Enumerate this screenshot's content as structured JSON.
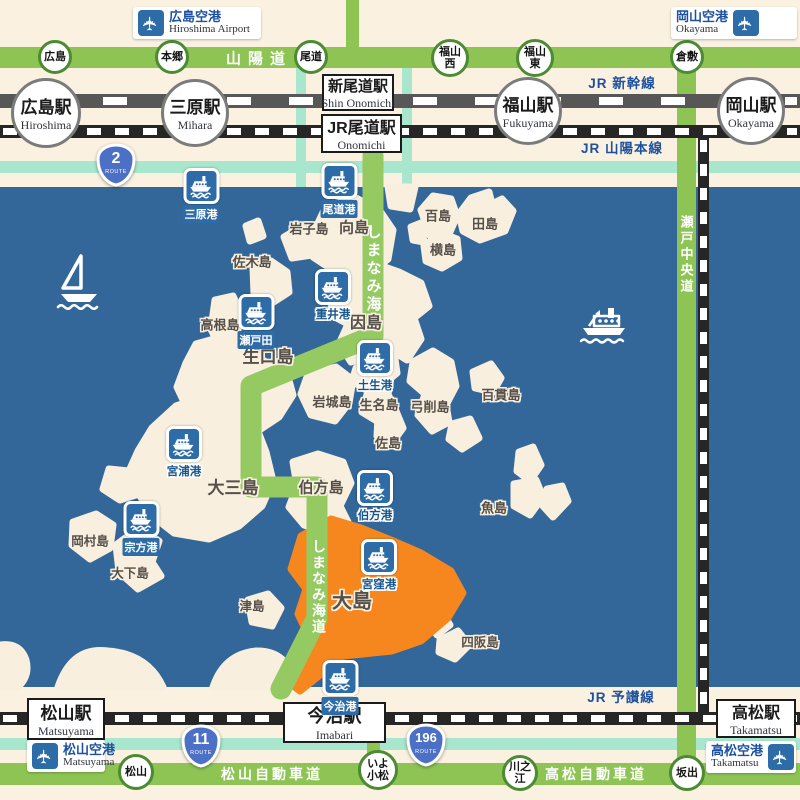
{
  "colors": {
    "land": "#FAF1E0",
    "island": "#F8EFDE",
    "sea": "#336699",
    "expressway_green": "#8DC454",
    "shimanami_green": "#95CA62",
    "local_teal": "#A8E6CD",
    "rail_gray": "#575757",
    "rail_black": "#262626",
    "marker_blue": "#2E6CA8",
    "label_blue": "#1D509E",
    "highlight_orange": "#F6871F",
    "ic_border_green": "#4C8A33"
  },
  "airports": [
    {
      "id": "hiroshima",
      "jp": "広島空港",
      "en": "Hiroshima Airport",
      "plane": "left",
      "x": 133,
      "y": 7,
      "w": 128
    },
    {
      "id": "okayama",
      "jp": "岡山空港",
      "en": "Okayama",
      "plane": "right",
      "x": 671,
      "y": 7,
      "w": 126
    },
    {
      "id": "matsuyama",
      "jp": "松山空港",
      "en": "Matsuyama",
      "plane": "left",
      "x": 27,
      "y": 740,
      "w": 78
    },
    {
      "id": "takamatsu",
      "jp": "高松空港",
      "en": "Takamatsu",
      "plane": "right",
      "x": 706,
      "y": 741,
      "w": 90
    }
  ],
  "station_circles": [
    {
      "id": "hiroshima",
      "jp": "広島駅",
      "en": "Hiroshima",
      "x": 46,
      "y": 113,
      "r": 35
    },
    {
      "id": "mihara",
      "jp": "三原駅",
      "en": "Mihara",
      "x": 195,
      "y": 113,
      "r": 34
    },
    {
      "id": "fukuyama",
      "jp": "福山駅",
      "en": "Fukuyama",
      "x": 528,
      "y": 111,
      "r": 34
    },
    {
      "id": "okayama",
      "jp": "岡山駅",
      "en": "Okayama",
      "x": 751,
      "y": 111,
      "r": 34
    }
  ],
  "station_boxes": [
    {
      "id": "shin-onomichi",
      "jp": "新尾道駅",
      "en": "Shin Onomichi",
      "x": 322,
      "y": 74,
      "w": 72,
      "h": 37,
      "jpsize": 15
    },
    {
      "id": "jr-onomichi",
      "jp": "JR尾道駅",
      "en": "Onomichi",
      "x": 321,
      "y": 114,
      "w": 81,
      "h": 39,
      "jpsize": 16
    },
    {
      "id": "matsuyama",
      "jp": "松山駅",
      "en": "Matsuyama",
      "x": 27,
      "y": 698,
      "w": 78,
      "h": 42,
      "jpsize": 17
    },
    {
      "id": "imabari",
      "jp": "今治駅",
      "en": "Imabari",
      "x": 283,
      "y": 702,
      "w": 103,
      "h": 41,
      "jpsize": 18
    },
    {
      "id": "takamatsu",
      "jp": "高松駅",
      "en": "Takamatsu",
      "x": 716,
      "y": 699,
      "w": 80,
      "h": 39,
      "jpsize": 16
    }
  ],
  "rail_labels": [
    {
      "id": "shinkansen",
      "text": "JR 新幹線",
      "x": 622,
      "y": 82
    },
    {
      "id": "sanyo-main-line",
      "text": "JR 山陽本線",
      "x": 622,
      "y": 147
    },
    {
      "id": "yosan-line",
      "text": "JR 予讃線",
      "x": 621,
      "y": 696
    }
  ],
  "road_labels": [
    {
      "id": "sanyo-expressway",
      "text": "山陽道",
      "x": 259,
      "y": 58,
      "vertical": false,
      "size": 15,
      "spacing": 7
    },
    {
      "id": "matsuyama-expressway",
      "text": "松山自動車道",
      "x": 272,
      "y": 774,
      "vertical": false,
      "size": 14,
      "spacing": 3
    },
    {
      "id": "takamatsu-expressway",
      "text": "高松自動車道",
      "x": 596,
      "y": 774,
      "vertical": false,
      "size": 14,
      "spacing": 3
    },
    {
      "id": "seto-chuo-expressway",
      "text": "瀬戸中央道",
      "x": 686,
      "y": 255,
      "vertical": true,
      "size": 13,
      "spacing": 3
    },
    {
      "id": "shimanami-kaido-north",
      "text": "しまなみ海道",
      "x": 373,
      "y": 278,
      "vertical": true,
      "size": 15,
      "spacing": 3
    },
    {
      "id": "shimanami-kaido-south",
      "text": "しまなみ海道",
      "x": 319,
      "y": 587,
      "vertical": true,
      "size": 14,
      "spacing": 2
    }
  ],
  "interchanges": [
    {
      "id": "hiroshima",
      "label": "広島",
      "x": 55,
      "y": 57,
      "r": 17
    },
    {
      "id": "hongo",
      "label": "本郷",
      "x": 172,
      "y": 57,
      "r": 17
    },
    {
      "id": "onomichi",
      "label": "尾道",
      "x": 311,
      "y": 57,
      "r": 17
    },
    {
      "id": "fukuyama-nishi",
      "label": "福山\n西",
      "x": 450,
      "y": 58,
      "r": 19
    },
    {
      "id": "fukuyama-higashi",
      "label": "福山\n東",
      "x": 535,
      "y": 58,
      "r": 19
    },
    {
      "id": "kurashiki",
      "label": "倉敷",
      "x": 687,
      "y": 57,
      "r": 17
    },
    {
      "id": "matsuyama",
      "label": "松山",
      "x": 136,
      "y": 772,
      "r": 18
    },
    {
      "id": "iyo-komatsu",
      "label": "いよ\n小松",
      "x": 378,
      "y": 770,
      "r": 20
    },
    {
      "id": "kawanoe",
      "label": "川之江",
      "x": 520,
      "y": 773,
      "r": 18
    },
    {
      "id": "sakaide",
      "label": "坂出",
      "x": 687,
      "y": 773,
      "r": 18
    }
  ],
  "route_badges": [
    {
      "id": "route-2",
      "number": "2",
      "word": "ROUTE",
      "x": 116,
      "y": 165
    },
    {
      "id": "route-11",
      "number": "11",
      "word": "ROUTE",
      "x": 201,
      "y": 746
    },
    {
      "id": "route-196",
      "number": "196",
      "word": "ROUTE",
      "x": 426,
      "y": 745
    }
  ],
  "ports": [
    {
      "id": "mihara",
      "label": "三原港",
      "x": 201,
      "y": 186,
      "style": "pill"
    },
    {
      "id": "onomichi",
      "label": "尾道港",
      "x": 339,
      "y": 181,
      "style": "pill"
    },
    {
      "id": "shigei",
      "label": "重井港",
      "x": 333,
      "y": 287,
      "style": "stroke"
    },
    {
      "id": "setoda",
      "label": "瀬戸田",
      "x": 256,
      "y": 312,
      "style": "pill"
    },
    {
      "id": "habu",
      "label": "土生港",
      "x": 375,
      "y": 358,
      "style": "stroke"
    },
    {
      "id": "miyaura",
      "label": "宮浦港",
      "x": 184,
      "y": 444,
      "style": "stroke"
    },
    {
      "id": "munakata",
      "label": "宗方港",
      "x": 141,
      "y": 519,
      "style": "pill"
    },
    {
      "id": "hakata",
      "label": "伯方港",
      "x": 375,
      "y": 488,
      "style": "stroke"
    },
    {
      "id": "miyakubo",
      "label": "宮窪港",
      "x": 379,
      "y": 557,
      "style": "stroke"
    },
    {
      "id": "imabari",
      "label": "今治港",
      "x": 340,
      "y": 678,
      "style": "pill"
    }
  ],
  "island_labels": [
    {
      "id": "mukaishima",
      "text": "向島",
      "x": 354,
      "y": 227,
      "size": 15
    },
    {
      "id": "iwashijima",
      "text": "岩子島",
      "x": 309,
      "y": 228,
      "size": 13
    },
    {
      "id": "hyakushima",
      "text": "百島",
      "x": 438,
      "y": 215,
      "size": 13
    },
    {
      "id": "tashima",
      "text": "田島",
      "x": 485,
      "y": 223,
      "size": 13
    },
    {
      "id": "yokoshima",
      "text": "横島",
      "x": 443,
      "y": 249,
      "size": 13
    },
    {
      "id": "sagishima",
      "text": "佐木島",
      "x": 252,
      "y": 261,
      "size": 13
    },
    {
      "id": "kouneshima",
      "text": "高根島",
      "x": 220,
      "y": 324,
      "size": 13
    },
    {
      "id": "innoshima",
      "text": "因島",
      "x": 366,
      "y": 321,
      "size": 16
    },
    {
      "id": "ikuchijima",
      "text": "生口島",
      "x": 268,
      "y": 355,
      "size": 17
    },
    {
      "id": "iwagijima",
      "text": "岩城島",
      "x": 332,
      "y": 401,
      "size": 13
    },
    {
      "id": "ikinajima",
      "text": "生名島",
      "x": 379,
      "y": 404,
      "size": 13
    },
    {
      "id": "yugeshima",
      "text": "弓削島",
      "x": 430,
      "y": 406,
      "size": 13
    },
    {
      "id": "hyakkanjima",
      "text": "百貫島",
      "x": 501,
      "y": 394,
      "size": 13
    },
    {
      "id": "sashima",
      "text": "佐島",
      "x": 388,
      "y": 442,
      "size": 13
    },
    {
      "id": "omishima",
      "text": "大三島",
      "x": 233,
      "y": 486,
      "size": 17
    },
    {
      "id": "hakatajima",
      "text": "伯方島",
      "x": 321,
      "y": 487,
      "size": 15
    },
    {
      "id": "uoshima",
      "text": "魚島",
      "x": 494,
      "y": 507,
      "size": 13
    },
    {
      "id": "okamurajima",
      "text": "岡村島",
      "x": 90,
      "y": 540,
      "size": 12.5
    },
    {
      "id": "ogejima",
      "text": "大下島",
      "x": 130,
      "y": 572,
      "size": 12.5
    },
    {
      "id": "tsushima",
      "text": "津島",
      "x": 252,
      "y": 605,
      "size": 12.5
    },
    {
      "id": "oshima",
      "text": "大島",
      "x": 352,
      "y": 599,
      "size": 20
    },
    {
      "id": "shisakajima",
      "text": "四阪島",
      "x": 480,
      "y": 641,
      "size": 12.5
    }
  ]
}
